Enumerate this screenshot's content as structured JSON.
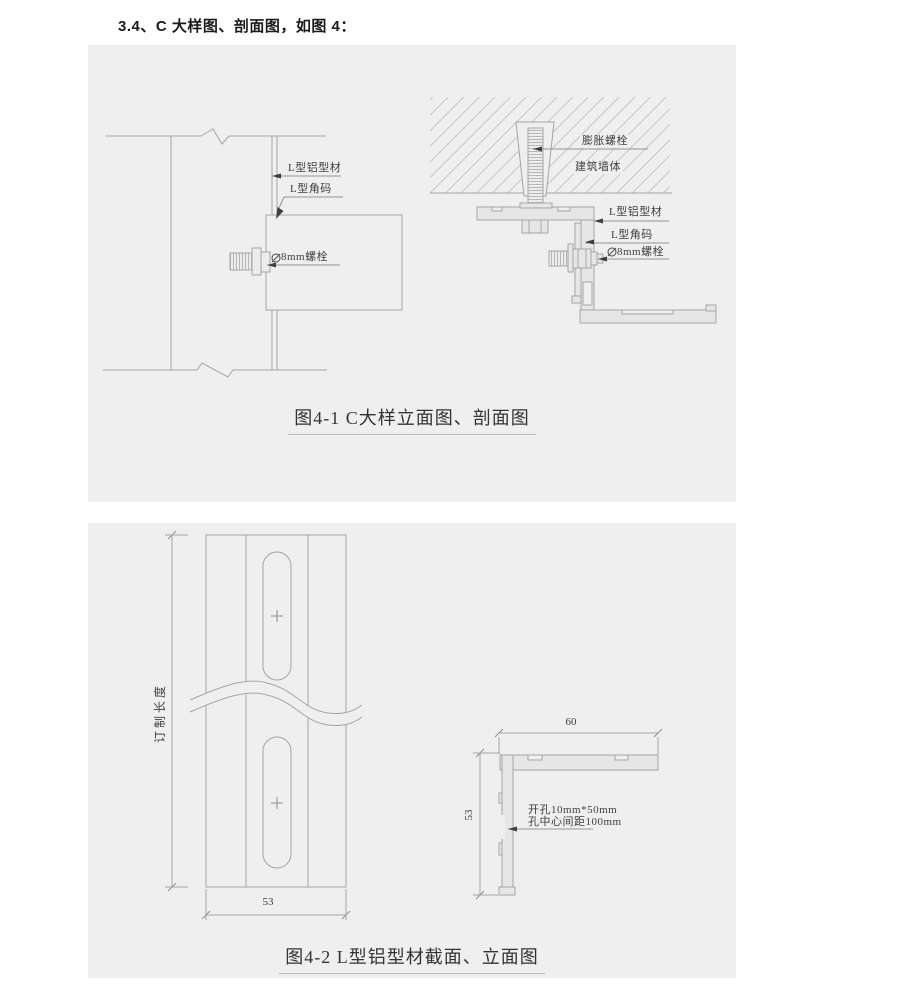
{
  "heading": "3.4、C 大样图、剖面图，如图 4：",
  "figure1": {
    "caption": "图4-1 C大样立面图、剖面图",
    "elevation_labels": {
      "profile": "L型铝型材",
      "angle_code": "L型角码",
      "bolt": "8mm螺栓"
    },
    "section_labels": {
      "expansion_bolt": "膨胀螺栓",
      "wall": "建筑墙体",
      "profile": "L型铝型材",
      "angle_code": "L型角码",
      "bolt": "8mm螺栓"
    }
  },
  "figure2": {
    "caption": "图4-2 L型铝型材截面、立面图",
    "front_view": {
      "length_dim": "订制长度",
      "width_dim": "53"
    },
    "section_view": {
      "width_dim": "60",
      "height_dim": "53",
      "hole_note_line1": "开孔10mm*50mm",
      "hole_note_line2": "孔中心间距100mm"
    }
  },
  "colors": {
    "panel_bg": "#efefef",
    "drawing_line": "#a5a5a5",
    "label_text": "#3f3f3f",
    "profile_fill": "#e6e6e6",
    "hatch_line": "#c6c6c6"
  }
}
